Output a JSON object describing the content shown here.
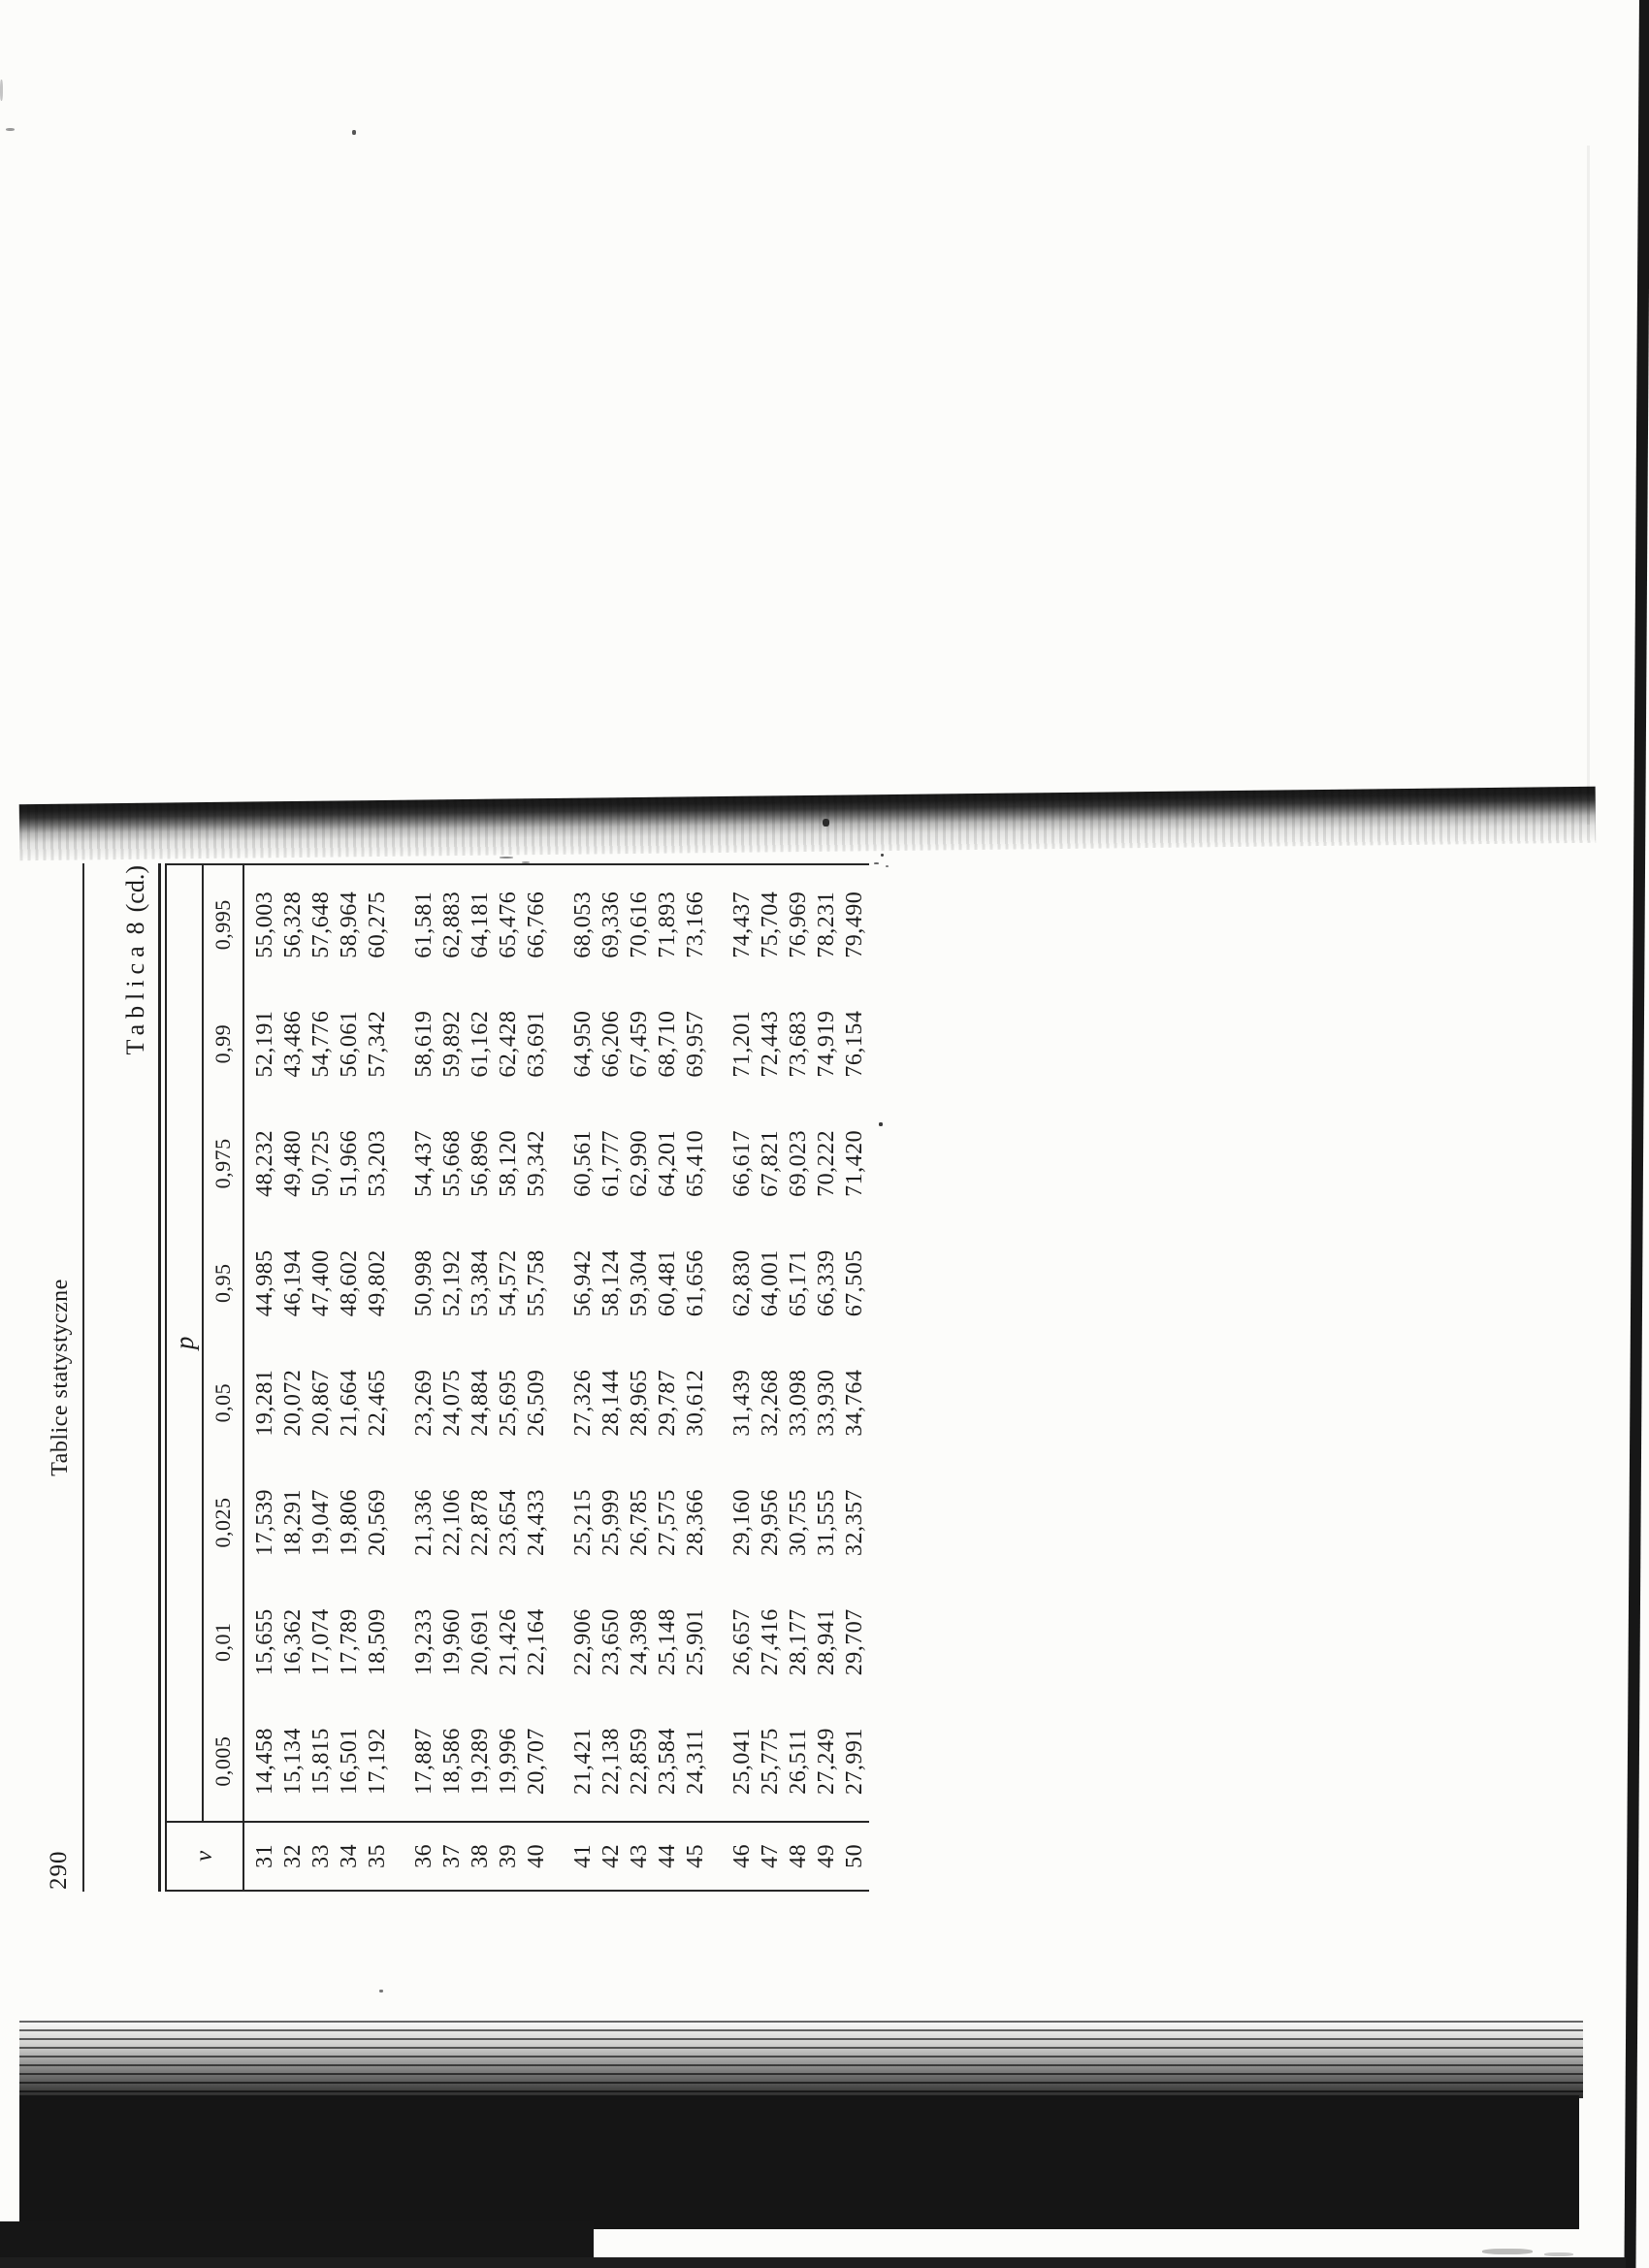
{
  "page": {
    "number": "290",
    "running_head": "Tablice statystyczne"
  },
  "title": {
    "word": "Tablica",
    "number": "8",
    "suffix": "(cd.)"
  },
  "colors": {
    "ink": "#1c1c1c",
    "paper": "#fcfcfa",
    "scan_black": "#151515"
  },
  "chart_data": {
    "type": "table",
    "title": "Tablica 8 (cd.)",
    "nu_symbol": "ν",
    "p_symbol": "p",
    "p_values": [
      "0,005",
      "0,01",
      "0,025",
      "0,05",
      "0,95",
      "0,975",
      "0,99",
      "0,995"
    ],
    "rows": [
      [
        "31",
        "14,458",
        "15,655",
        "17,539",
        "19,281",
        "44,985",
        "48,232",
        "52,191",
        "55,003"
      ],
      [
        "32",
        "15,134",
        "16,362",
        "18,291",
        "20,072",
        "46,194",
        "49,480",
        "43,486",
        "56,328"
      ],
      [
        "33",
        "15,815",
        "17,074",
        "19,047",
        "20,867",
        "47,400",
        "50,725",
        "54,776",
        "57,648"
      ],
      [
        "34",
        "16,501",
        "17,789",
        "19,806",
        "21,664",
        "48,602",
        "51,966",
        "56,061",
        "58,964"
      ],
      [
        "35",
        "17,192",
        "18,509",
        "20,569",
        "22,465",
        "49,802",
        "53,203",
        "57,342",
        "60,275"
      ],
      [
        "36",
        "17,887",
        "19,233",
        "21,336",
        "23,269",
        "50,998",
        "54,437",
        "58,619",
        "61,581"
      ],
      [
        "37",
        "18,586",
        "19,960",
        "22,106",
        "24,075",
        "52,192",
        "55,668",
        "59,892",
        "62,883"
      ],
      [
        "38",
        "19,289",
        "20,691",
        "22,878",
        "24,884",
        "53,384",
        "56,896",
        "61,162",
        "64,181"
      ],
      [
        "39",
        "19,996",
        "21,426",
        "23,654",
        "25,695",
        "54,572",
        "58,120",
        "62,428",
        "65,476"
      ],
      [
        "40",
        "20,707",
        "22,164",
        "24,433",
        "26,509",
        "55,758",
        "59,342",
        "63,691",
        "66,766"
      ],
      [
        "41",
        "21,421",
        "22,906",
        "25,215",
        "27,326",
        "56,942",
        "60,561",
        "64,950",
        "68,053"
      ],
      [
        "42",
        "22,138",
        "23,650",
        "25,999",
        "28,144",
        "58,124",
        "61,777",
        "66,206",
        "69,336"
      ],
      [
        "43",
        "22,859",
        "24,398",
        "26,785",
        "28,965",
        "59,304",
        "62,990",
        "67,459",
        "70,616"
      ],
      [
        "44",
        "23,584",
        "25,148",
        "27,575",
        "29,787",
        "60,481",
        "64,201",
        "68,710",
        "71,893"
      ],
      [
        "45",
        "24,311",
        "25,901",
        "28,366",
        "30,612",
        "61,656",
        "65,410",
        "69,957",
        "73,166"
      ],
      [
        "46",
        "25,041",
        "26,657",
        "29,160",
        "31,439",
        "62,830",
        "66,617",
        "71,201",
        "74,437"
      ],
      [
        "47",
        "25,775",
        "27,416",
        "29,956",
        "32,268",
        "64,001",
        "67,821",
        "72,443",
        "75,704"
      ],
      [
        "48",
        "26,511",
        "28,177",
        "30,755",
        "33,098",
        "65,171",
        "69,023",
        "73,683",
        "76,969"
      ],
      [
        "49",
        "27,249",
        "28,941",
        "31,555",
        "33,930",
        "66,339",
        "70,222",
        "74,919",
        "78,231"
      ],
      [
        "50",
        "27,991",
        "29,707",
        "32,357",
        "34,764",
        "67,505",
        "71,420",
        "76,154",
        "79,490"
      ]
    ],
    "group_size": 5,
    "layout": "page rotated 90deg counterclockwise (landscape table on portrait scan)"
  }
}
